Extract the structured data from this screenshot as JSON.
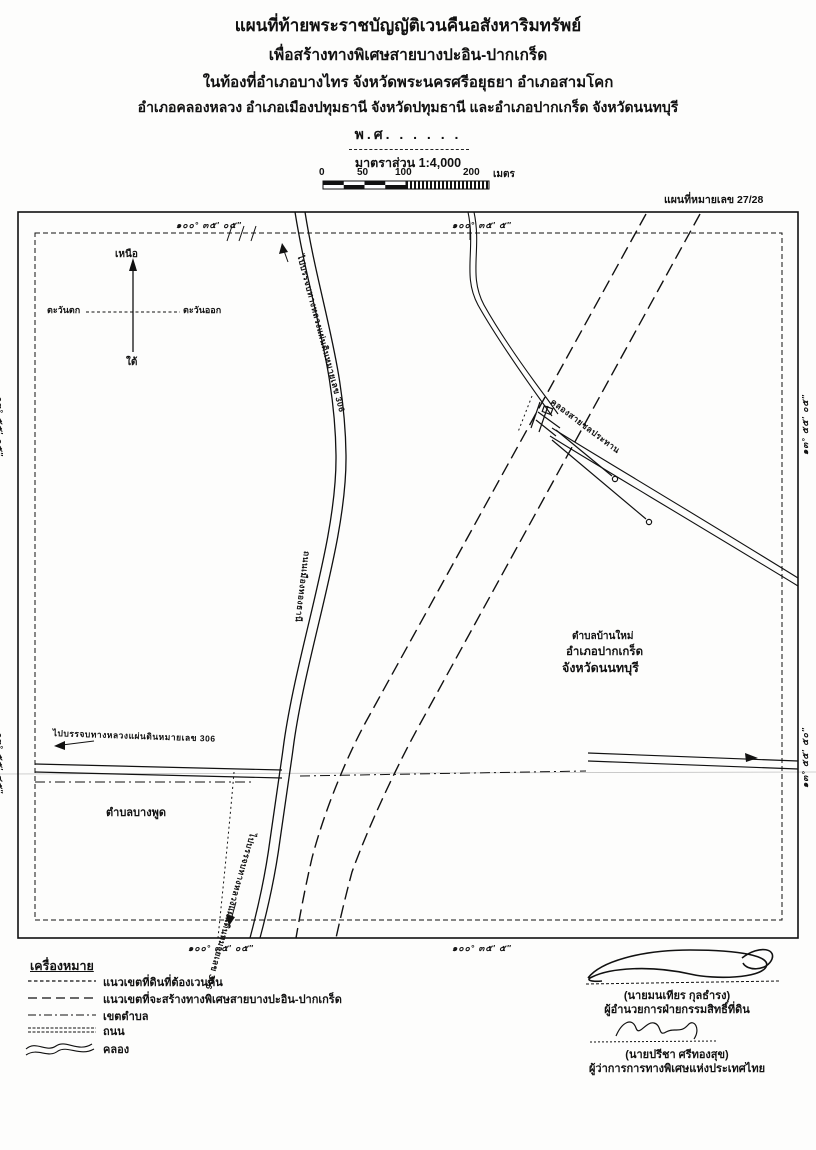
{
  "title": {
    "line1": "แผนที่ท้ายพระราชบัญญัติเวนคืนอสังหาริมทรัพย์",
    "line2": "เพื่อสร้างทางพิเศษสายบางปะอิน-ปากเกร็ด",
    "line3": "ในท้องที่อำเภอบางไทร จังหวัดพระนครศรีอยุธยา อำเภอสามโคก",
    "line4": "อำเภอคลองหลวง อำเภอเมืองปทุมธานี จังหวัดปทุมธานี และอำเภอปากเกร็ด จังหวัดนนทบุรี",
    "year": "พ.ศ. . . . . .",
    "scale_label": "มาตราส่วน 1:4,000"
  },
  "scalebar": {
    "t0": "0",
    "t50": "50",
    "t100": "100",
    "t200": "200",
    "unit": "เมตร"
  },
  "map_no": "แผนที่หมายเลข 27/28",
  "compass": {
    "north": "เหนือ",
    "south": "ใต้",
    "east": "ตะวันออก",
    "west": "ตะวันตก"
  },
  "coords": {
    "top_left": "๑๐๐° ๓๕′ ๐๕″",
    "top_right": "๑๐๐° ๓๕′ ๕″",
    "bottom_left": "๑๐๐° ๓๕′ ๐๕″",
    "bottom_right": "๑๐๐° ๓๕′ ๕″",
    "left_top": "๑๓° ๕๕′ ๐๕″",
    "left_bottom": "๑๓° ๕๕′ ๔๕″",
    "right_top": "๑๓° ๕๕′ ๐๕″",
    "right_bottom": "๑๓° ๕๕′ ๕๐″"
  },
  "map_labels": {
    "road_to_306_top": "ไปบรรจบทางหลวงแผ่นดินหมายเลข 306",
    "road_name": "ถนนเมืองทองธานี",
    "road_to_306_left": "ไปบรรจบทางหลวงแผ่นดินหมายเลข 306",
    "road_to_306_bottom": "ไปบรรจบทางหลวงแผ่นดินหมายเลข 306",
    "canal_name": "คลองสายชลประทาน",
    "tambon_ban_mai": "ตำบลบ้านใหม่",
    "amphoe_pak_kret": "อำเภอปากเกร็ด",
    "changwat_nonthaburi": "จังหวัดนนทบุรี",
    "tambon_bang_phut": "ตำบลบางพูด"
  },
  "legend": {
    "header": "เครื่องหมาย",
    "items": [
      {
        "symbol": "fine-dash-line",
        "label": "แนวเขตที่ดินที่ต้องเวนคืน"
      },
      {
        "symbol": "long-dash-line",
        "label": "แนวเขตที่จะสร้างทางพิเศษสายบางปะอิน-ปากเกร็ด"
      },
      {
        "symbol": "dash-dot-line",
        "label": "เขตตำบล"
      },
      {
        "symbol": "double-line",
        "label": "ถนน"
      },
      {
        "symbol": "wavy-line",
        "label": "คลอง"
      }
    ]
  },
  "signatures": {
    "name1": "(นายมนเทียร กุลธำรง)",
    "title1": "ผู้อำนวยการฝ่ายกรรมสิทธิ์ที่ดิน",
    "name2": "(นายปรีชา ศรีทองสุข)",
    "title2": "ผู้ว่าการการทางพิเศษแห่งประเทศไทย"
  }
}
